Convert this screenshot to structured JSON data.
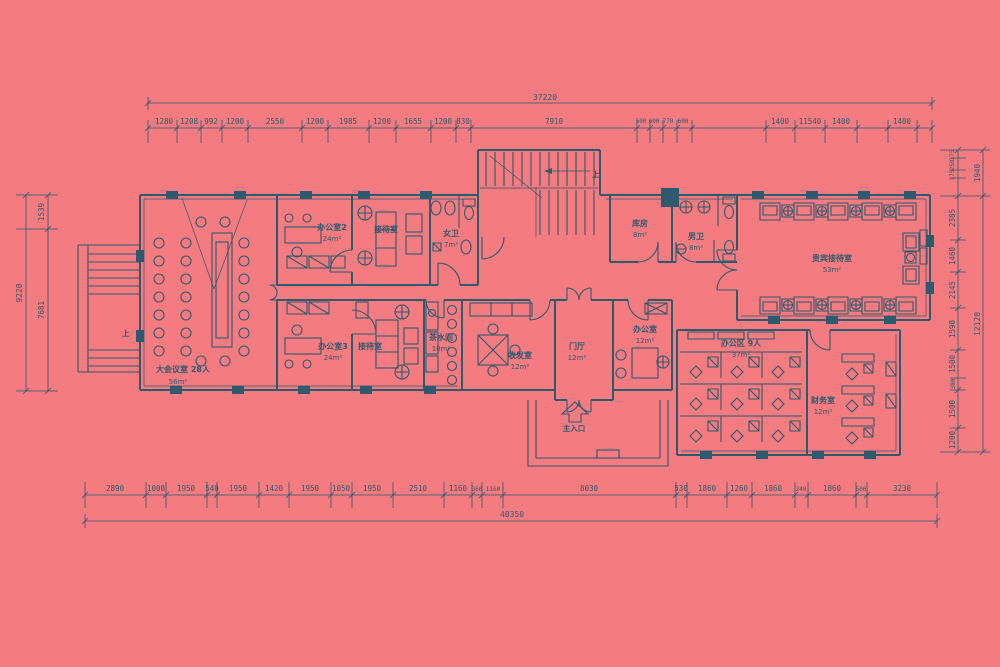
{
  "colors": {
    "background": "#f47b7f",
    "line": "#2e5a6e"
  },
  "dims": {
    "top": {
      "total": "37220",
      "segments": [
        "1280",
        "1208",
        "992",
        "1200",
        "2550",
        "1200",
        "1985",
        "1200",
        "1655",
        "1200",
        "830",
        "7910",
        "500",
        "600",
        "770",
        "600",
        "1400",
        "11540",
        "1400",
        "1400"
      ]
    },
    "bottom": {
      "total": "40350",
      "segments": [
        "2890",
        "1000",
        "1950",
        "540",
        "1950",
        "1420",
        "1950",
        "1050",
        "1950",
        "2510",
        "1160",
        "360",
        "1160",
        "8030",
        "530",
        "1860",
        "1260",
        "1860",
        "240",
        "1860",
        "500",
        "3230"
      ]
    },
    "left": {
      "total": "9220",
      "segments": [
        "1539",
        "7681"
      ]
    },
    "right": {
      "outer": [
        "1940",
        "12120"
      ],
      "segments": [
        "175",
        "250",
        "175",
        "2385",
        "1460",
        "2145",
        "1590",
        "1500",
        "380",
        "1500",
        "1200"
      ]
    }
  },
  "rooms": {
    "conference": {
      "name": "大会议室 28人",
      "area": "56m²"
    },
    "office2": {
      "name": "办公室2",
      "area": "24m²"
    },
    "reception_top": {
      "name": "接待室"
    },
    "office3": {
      "name": "办公室3",
      "area": "24m²"
    },
    "reception_bottom": {
      "name": "接待室"
    },
    "womens_wc": {
      "name": "女卫",
      "area": "7m²"
    },
    "tea_room": {
      "name": "茶水间",
      "area": "10m²"
    },
    "mail_room": {
      "name": "收发室",
      "area": "12m²"
    },
    "lobby": {
      "name": "门厅",
      "area": "12m²"
    },
    "office_center": {
      "name": "办公室",
      "area": "12m²"
    },
    "storage": {
      "name": "库房",
      "area": "8m²"
    },
    "mens_wc": {
      "name": "男卫",
      "area": "8m²"
    },
    "vip_reception": {
      "name": "贵宾接待室",
      "area": "53m²"
    },
    "open_office": {
      "name": "办公区 9人",
      "area": "37m²"
    },
    "finance": {
      "name": "财务室",
      "area": "12m²"
    }
  },
  "annotations": {
    "entrance": "主入口",
    "up": "上"
  }
}
